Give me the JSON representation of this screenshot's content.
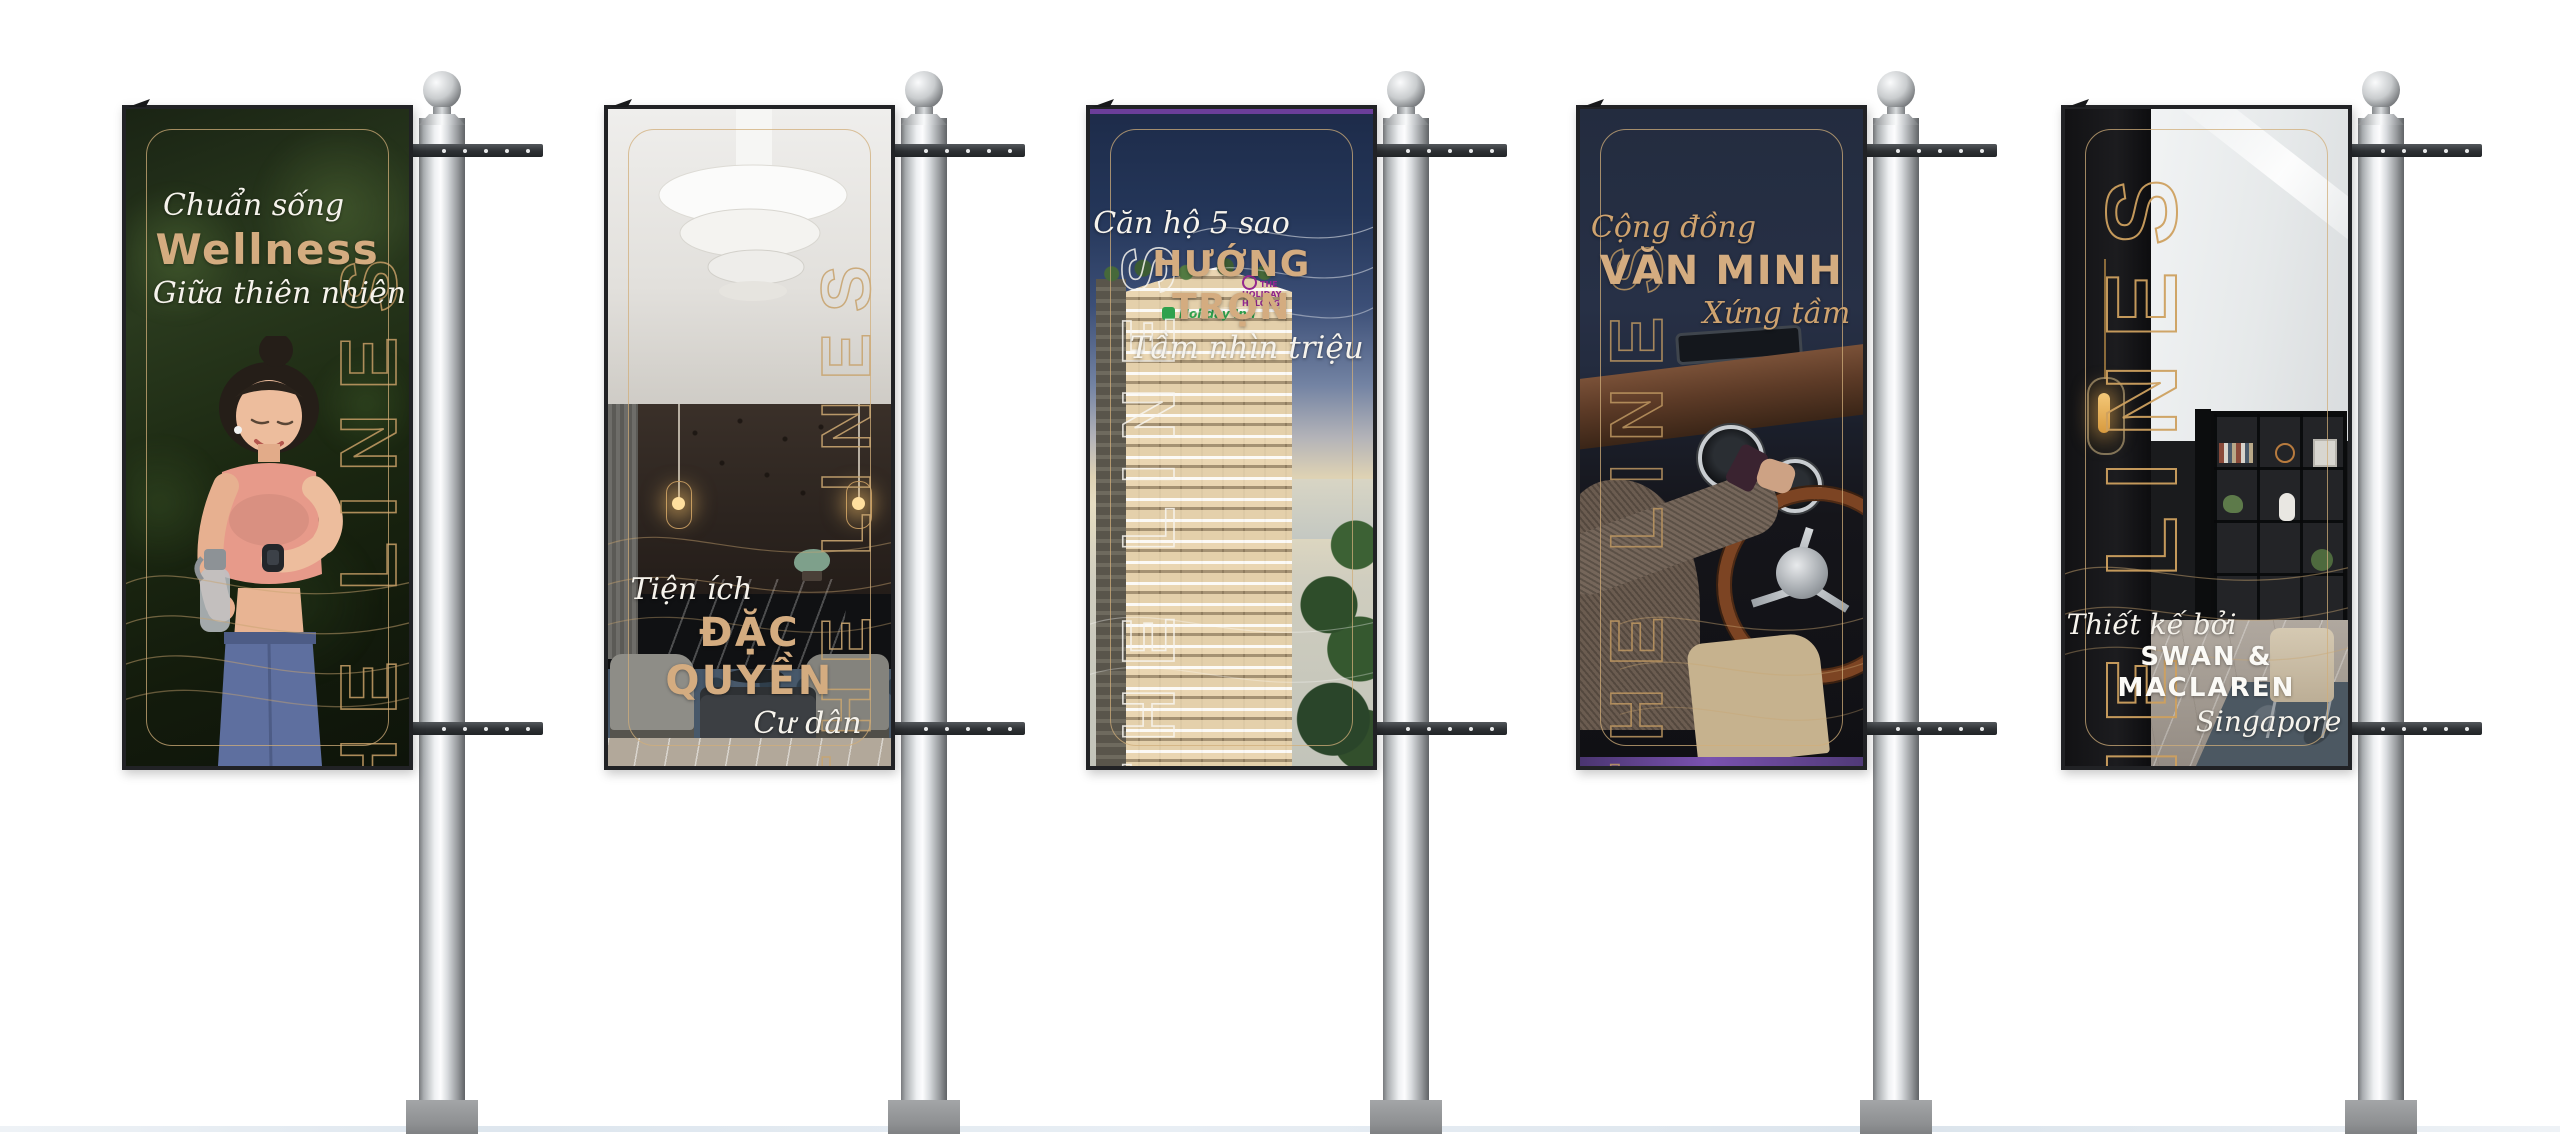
{
  "scene": {
    "name": "the-lines-street-banner-mockup",
    "background": "#ffffff",
    "units": 5
  },
  "colors": {
    "accent_gold": "#c49a62",
    "heading_tan": "#d4ac80",
    "script_white": "#f6f3ec",
    "script_gold": "#cfa36f",
    "strip_purple": "#5a3f8e",
    "holiday_inn_green": "#2f9e4d",
    "holiday_hotel_purple": "#93278f",
    "pole_chrome": "#c9ccd0"
  },
  "banners": [
    {
      "id": "banner-wellness",
      "artwork": "woman-checking-smartwatch-in-forest",
      "vertical_text": "THE LINES",
      "script_top": "Chuẩn sống",
      "headline": "Wellness",
      "script_bottom": "Giữa thiên nhiên"
    },
    {
      "id": "banner-dac-quyen",
      "artwork": "luxury-lounge-interior",
      "vertical_text": "THE LINES",
      "script_top": "Tiện ích",
      "headline": "ĐẶC QUYỀN",
      "script_bottom": "Cư dân"
    },
    {
      "id": "banner-huong-tron",
      "artwork": "seaside-tower-residence",
      "vertical_text": "THE LINES",
      "script_top": "Căn hộ 5 sao",
      "headline": "HƯỚNG TRỌN",
      "script_bottom": "Tầm nhìn triệu $",
      "signs": [
        "Holiday Inn",
        "THE HOLIDAY HALONG"
      ]
    },
    {
      "id": "banner-van-minh",
      "artwork": "classic-car-driver",
      "vertical_text": "THE LINES",
      "script_top": "Cộng đồng",
      "headline": "VĂN MINH",
      "script_bottom": "Xứng tầm"
    },
    {
      "id": "banner-swan-maclaren",
      "artwork": "designer-apartment-interior",
      "vertical_text": "THE LINES",
      "script_top": "Thiết kế bởi",
      "headline": "SWAN & MACLAREN",
      "script_bottom": "Singapore"
    }
  ]
}
